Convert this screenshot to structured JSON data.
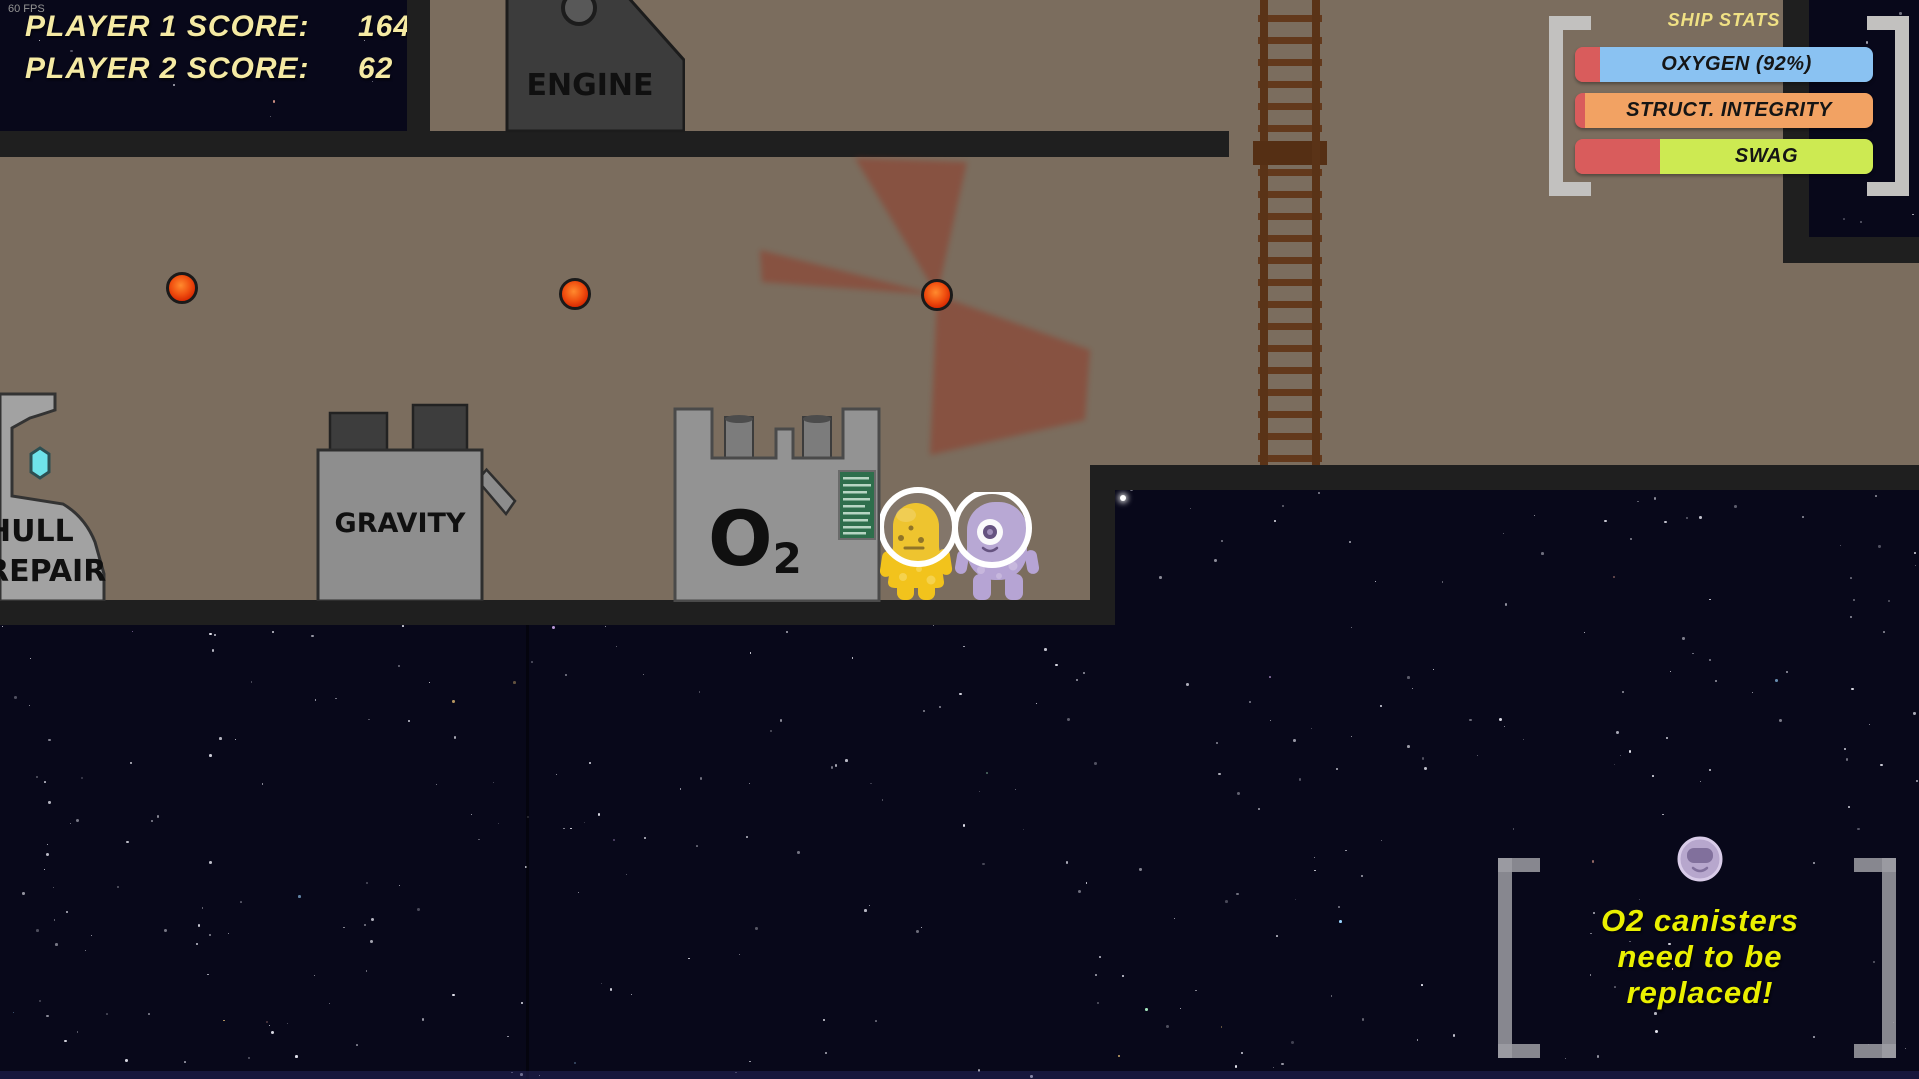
{
  "hud": {
    "fps_counter": "60 FPS",
    "score_panel": {
      "rows": [
        {
          "label": "PLAYER 1 SCORE:",
          "value": "164"
        },
        {
          "label": "PLAYER 2 SCORE:",
          "value": "62"
        }
      ],
      "text_color": "#f5eaa3"
    },
    "ship_stats": {
      "title": "SHIP STATS",
      "depleted_color": "#d95c5c",
      "bars": [
        {
          "label": "OXYGEN (92%)",
          "fill_color": "#8ac2f2",
          "depleted_pct": 8.4
        },
        {
          "label": "STRUCT. INTEGRITY",
          "fill_color": "#f2a263",
          "depleted_pct": 3.4
        },
        {
          "label": "SWAG",
          "fill_color": "#cdea52",
          "depleted_pct": 28.5
        }
      ]
    },
    "notification": {
      "icon": "purple-alien-avatar",
      "lines": [
        "O2 canisters",
        "need to be",
        "replaced!"
      ],
      "text_color": "#eaf000"
    }
  },
  "machines": {
    "engine": {
      "label": "ENGINE"
    },
    "gravity": {
      "label": "GRAVITY"
    },
    "oxygen": {
      "label_main": "O",
      "label_sub": "2"
    },
    "hull_repair": {
      "lines": [
        "HULL",
        "REPAIR"
      ]
    }
  },
  "entities": {
    "players": [
      {
        "name": "player-1-yellow-alien",
        "body_color": "#f2c31c"
      },
      {
        "name": "player-2-purple-alien",
        "body_color": "#b6a4d4"
      }
    ],
    "oxygen_canisters": {
      "count": 3,
      "color": "#e03000"
    }
  },
  "environment": {
    "wall_color": "#7b6d5e",
    "structure_color": "#1f1f1f",
    "ladder_color": "#5d3518",
    "space_color": "#08081a"
  }
}
